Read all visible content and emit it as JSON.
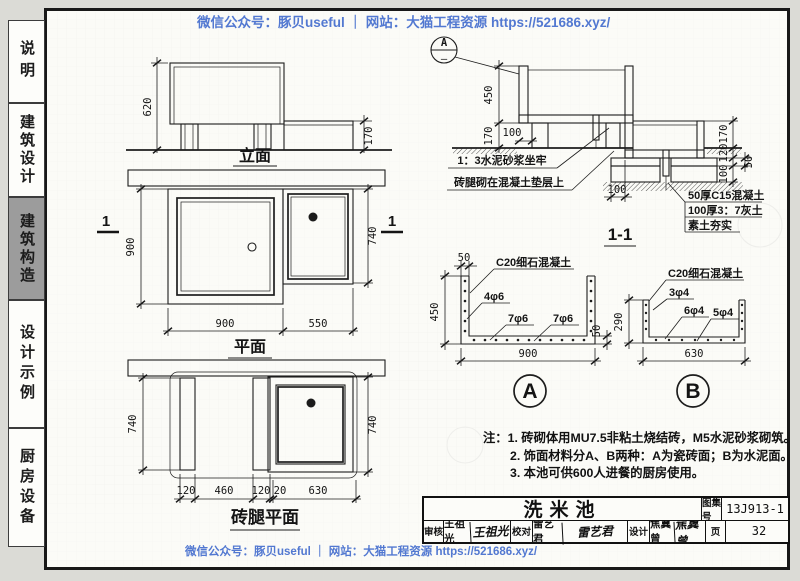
{
  "watermark": {
    "text": "微信公众号：豚贝useful ｜ 网站：大猫工程资源 https://521686.xyz/",
    "color": "#4a72cf"
  },
  "sidebar": {
    "tabs": [
      {
        "label": "说明",
        "active": false
      },
      {
        "label": "建筑设计",
        "active": false
      },
      {
        "label": "建筑构造",
        "active": true
      },
      {
        "label": "设计示例",
        "active": false
      },
      {
        "label": "厨房设备",
        "active": false
      }
    ]
  },
  "elevation": {
    "title": "立面",
    "dim_height": "620",
    "dim_right_height": "170"
  },
  "plan": {
    "title": "平面",
    "section_mark": "1",
    "dim_left": "900",
    "dim_right": "740",
    "dim_bottom": [
      "900",
      "550"
    ]
  },
  "brick_plan": {
    "title": "砖腿平面",
    "dim_left": "740",
    "dim_right": "740",
    "dim_bottom": [
      "120",
      "460",
      "120",
      "20",
      "630"
    ]
  },
  "section": {
    "title": "1-1",
    "callout_letter": "A",
    "callout_sub": "—",
    "dim_depth": "450",
    "dim_leg_height": "170",
    "dim_leg_inset": "100",
    "dim_pad_edge": "100",
    "dim_right": [
      "170",
      "120",
      "50",
      "100"
    ],
    "label_mortar": "1：3水泥砂浆坐牢",
    "label_leg": "砖腿砌在混凝土垫层上",
    "label_layers": [
      "50厚C15混凝土",
      "100厚3：7灰土",
      "素土夯实"
    ]
  },
  "detail_a": {
    "mark": "A",
    "material": "C20细石混凝土",
    "rebar_wall": "4φ6",
    "rebar_bottom1": "7φ6",
    "rebar_bottom2": "7φ6",
    "dim_wall": "50",
    "dim_depth": "450",
    "dim_slab": "50",
    "dim_width": "900"
  },
  "detail_b": {
    "mark": "B",
    "material": "C20细石混凝土",
    "rebar_wall": "3φ4",
    "rebar_bottom1": "6φ4",
    "rebar_bottom2": "5φ4",
    "dim_depth": "290",
    "dim_width": "630"
  },
  "notes": {
    "prefix": "注：",
    "lines": [
      "1. 砖砌体用MU7.5非粘土烧结砖，M5水泥砂浆砌筑。",
      "2. 饰面材料分A、B两种：A为瓷砖面；B为水泥面。",
      "3. 本池可供600人进餐的厨房使用。"
    ]
  },
  "title_block": {
    "title": "洗米池",
    "atlas_label": "图集号",
    "atlas_no": "13J913-1",
    "page_label": "页",
    "page_no": "32",
    "review_label": "审核",
    "reviewer": "王祖光",
    "reviewer_sig": "王祖光",
    "check_label": "校对",
    "checker": "雷艺君",
    "checker_sig": "雷艺君",
    "design_label": "设计",
    "designer": "焦冀曾",
    "designer_sig": "焦冀曾"
  }
}
